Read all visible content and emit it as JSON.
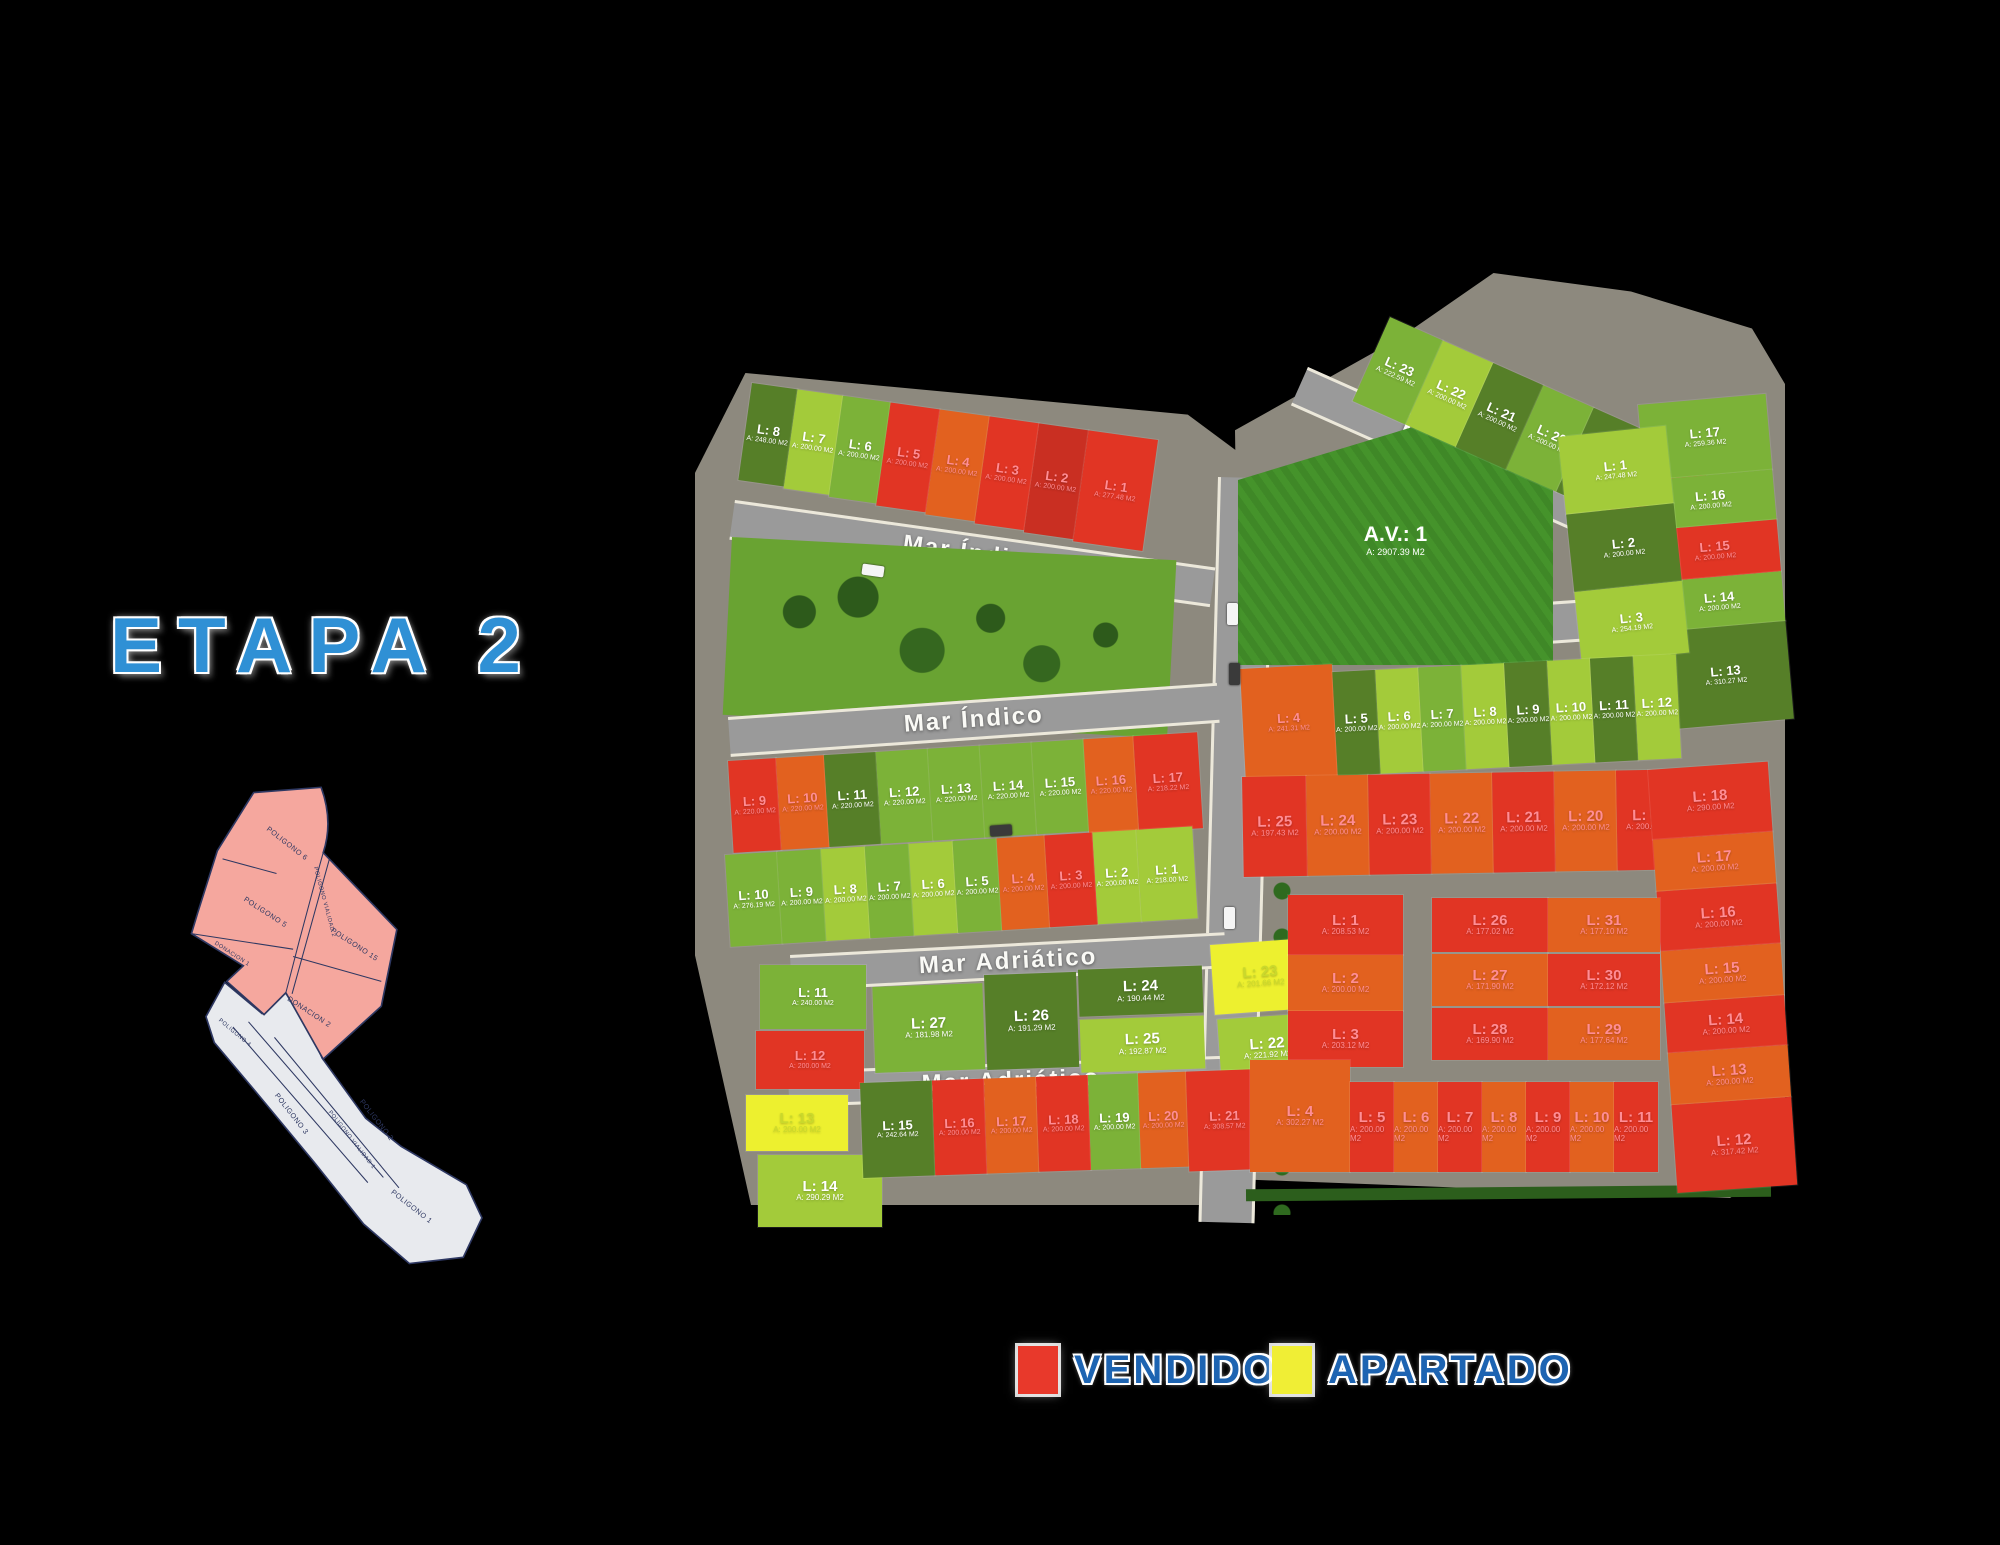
{
  "title": {
    "text": "ETAPA 2"
  },
  "legend": {
    "vendido": "VENDIDO",
    "apartado": "APARTADO"
  },
  "colors": {
    "g1": "#a3cb3a",
    "g2": "#7cb238",
    "g3": "#567f28",
    "r1": "#e13524",
    "r2": "#e2611f",
    "r3": "#c92f22",
    "y": "#edf02f",
    "av_field": "#45932b",
    "road": "#8f8f8f",
    "park": "#69a332",
    "legend_vendido": "#e8392b",
    "legend_apartado": "#f0ee35",
    "title_blue": "#2f90d5",
    "legend_blue": "#1d64b2"
  },
  "streets": [
    {
      "name": "Mar Índico"
    },
    {
      "name": "Mar Índico"
    },
    {
      "name": "Mar Rojo"
    },
    {
      "name": "Mar Rojo"
    },
    {
      "name": "Mar Adriático"
    },
    {
      "name": "Mar Adriático"
    }
  ],
  "inset": {
    "p6": "POLIGONO 6",
    "p5": "POLIGONO 5",
    "d1": "DONACION 1",
    "pv2": "POLIGONO VIALIDAD 2",
    "p15": "POLIGONO 15",
    "d2": "DONACION 2",
    "p4": "POLIGONO 4",
    "p3": "POLIGONO 3",
    "pv1": "POLIGONO VIALIDAD 1",
    "p2": "POLIGONO 2",
    "p1": "POLIGONO 1"
  },
  "zones": {
    "av": {
      "l": "A.V.: 1",
      "a": "A: 2907.39 M2"
    },
    "west_top_row": {
      "mode": "row",
      "lots": [
        {
          "l": "L: 8",
          "a": "A: 248.00 M2",
          "c": "g3",
          "w": 46,
          "h": 98
        },
        {
          "l": "L: 7",
          "a": "A: 200.00 M2",
          "c": "g1",
          "w": 46,
          "h": 100
        },
        {
          "l": "L: 6",
          "a": "A: 200.00 M2",
          "c": "g2",
          "w": 48,
          "h": 102
        },
        {
          "l": "L: 5",
          "a": "A: 200.00 M2",
          "c": "r1",
          "w": 50,
          "h": 104
        },
        {
          "l": "L: 4",
          "a": "A: 200.00 M2",
          "c": "r2",
          "w": 50,
          "h": 106
        },
        {
          "l": "L: 3",
          "a": "A: 200.00 M2",
          "c": "r1",
          "w": 50,
          "h": 108
        },
        {
          "l": "L: 2",
          "a": "A: 200.00 M2",
          "c": "r3",
          "w": 50,
          "h": 110
        },
        {
          "l": "L: 1",
          "a": "A: 277.48 M2",
          "c": "r1",
          "w": 70,
          "h": 112
        }
      ]
    },
    "west_mid_row1": {
      "mode": "row",
      "lots": [
        {
          "l": "L: 9",
          "a": "A: 220.00 M2",
          "c": "r1",
          "w": 48,
          "h": 92
        },
        {
          "l": "L: 10",
          "a": "A: 220.00 M2",
          "c": "r2",
          "w": 48,
          "h": 92
        },
        {
          "l": "L: 11",
          "a": "A: 220.00 M2",
          "c": "g3",
          "w": 52,
          "h": 92
        },
        {
          "l": "L: 12",
          "a": "A: 220.00 M2",
          "c": "g2",
          "w": 52,
          "h": 92
        },
        {
          "l": "L: 13",
          "a": "A: 220.00 M2",
          "c": "g2",
          "w": 52,
          "h": 92
        },
        {
          "l": "L: 14",
          "a": "A: 220.00 M2",
          "c": "g2",
          "w": 52,
          "h": 92
        },
        {
          "l": "L: 15",
          "a": "A: 220.00 M2",
          "c": "g2",
          "w": 52,
          "h": 92
        },
        {
          "l": "L: 16",
          "a": "A: 220.00 M2",
          "c": "r2",
          "w": 50,
          "h": 94
        },
        {
          "l": "L: 17",
          "a": "A: 218.22 M2",
          "c": "r1",
          "w": 64,
          "h": 96
        }
      ]
    },
    "west_mid_row2": {
      "mode": "row",
      "lots": [
        {
          "l": "L: 10",
          "a": "A: 276.19 M2",
          "c": "g2",
          "w": 52,
          "h": 92
        },
        {
          "l": "L: 9",
          "a": "A: 200.00 M2",
          "c": "g2",
          "w": 44,
          "h": 92
        },
        {
          "l": "L: 8",
          "a": "A: 200.00 M2",
          "c": "g1",
          "w": 44,
          "h": 92
        },
        {
          "l": "L: 7",
          "a": "A: 200.00 M2",
          "c": "g2",
          "w": 44,
          "h": 92
        },
        {
          "l": "L: 6",
          "a": "A: 200.00 M2",
          "c": "g1",
          "w": 44,
          "h": 92
        },
        {
          "l": "L: 5",
          "a": "A: 200.00 M2",
          "c": "g2",
          "w": 44,
          "h": 92
        },
        {
          "l": "L: 4",
          "a": "A: 200.00 M2",
          "c": "r2",
          "w": 48,
          "h": 92
        },
        {
          "l": "L: 3",
          "a": "A: 200.00 M2",
          "c": "r1",
          "w": 48,
          "h": 92
        },
        {
          "l": "L: 2",
          "a": "A: 200.00 M2",
          "c": "g1",
          "w": 44,
          "h": 92
        },
        {
          "l": "L: 1",
          "a": "A: 218.00 M2",
          "c": "g1",
          "w": 56,
          "h": 92
        }
      ]
    },
    "adriatico_left": {
      "mode": "free",
      "lots": [
        {
          "l": "L: 11",
          "a": "A: 240.00 M2",
          "c": "g2",
          "x": 4,
          "y": 2,
          "w": 106,
          "h": 64
        },
        {
          "l": "L: 12",
          "a": "A: 200.00 M2",
          "c": "r1",
          "x": 0,
          "y": 68,
          "w": 108,
          "h": 58
        }
      ]
    },
    "adriatico_island": {
      "mode": "free",
      "lots": [
        {
          "l": "L: 27",
          "a": "A: 181.98 M2",
          "c": "g2",
          "x": 0,
          "y": 10,
          "w": 110,
          "h": 86
        },
        {
          "l": "L: 26",
          "a": "A: 191.29 M2",
          "c": "g3",
          "x": 112,
          "y": 2,
          "w": 92,
          "h": 95
        },
        {
          "l": "L: 24",
          "a": "A: 190.44 M2",
          "c": "g3",
          "x": 206,
          "y": 0,
          "w": 124,
          "h": 47
        },
        {
          "l": "L: 25",
          "a": "A: 192.87 M2",
          "c": "g1",
          "x": 206,
          "y": 50,
          "w": 124,
          "h": 53
        }
      ]
    },
    "adriatico_right": {
      "mode": "free",
      "lots": [
        {
          "l": "L: 23",
          "a": "A: 201.66 M2",
          "c": "y",
          "x": 0,
          "y": 0,
          "w": 96,
          "h": 70
        },
        {
          "l": "L: 22",
          "a": "A: 221.92 M2",
          "c": "g1",
          "x": 2,
          "y": 75,
          "w": 96,
          "h": 64
        }
      ]
    },
    "west_bottom_left": {
      "mode": "free",
      "lots": [
        {
          "l": "L: 13",
          "a": "A: 200.00 M2",
          "c": "y",
          "x": 2,
          "y": 0,
          "w": 102,
          "h": 56
        },
        {
          "l": "L: 14",
          "a": "A: 290.29 M2",
          "c": "g1",
          "x": 14,
          "y": 60,
          "w": 124,
          "h": 72
        }
      ]
    },
    "west_bottom_row": {
      "mode": "row",
      "lots": [
        {
          "l": "L: 15",
          "a": "A: 242.64 M2",
          "c": "g3",
          "w": 72,
          "h": 95
        },
        {
          "l": "L: 16",
          "a": "A: 200.00 M2",
          "c": "r1",
          "w": 52,
          "h": 95
        },
        {
          "l": "L: 17",
          "a": "A: 200.00 M2",
          "c": "r2",
          "w": 52,
          "h": 95
        },
        {
          "l": "L: 18",
          "a": "A: 200.00 M2",
          "c": "r1",
          "w": 52,
          "h": 95
        },
        {
          "l": "L: 19",
          "a": "A: 200.00 M2",
          "c": "g2",
          "w": 50,
          "h": 95
        },
        {
          "l": "L: 20",
          "a": "A: 200.00 M2",
          "c": "r2",
          "w": 48,
          "h": 95
        },
        {
          "l": "L: 21",
          "a": "A: 308.57 M2",
          "c": "r1",
          "w": 74,
          "h": 100
        }
      ]
    },
    "east_top_row": {
      "mode": "row",
      "lots": [
        {
          "l": "L: 23",
          "a": "A: 222.59 M2",
          "c": "g2",
          "w": 58,
          "h": 92
        },
        {
          "l": "L: 22",
          "a": "A: 200.00 M2",
          "c": "g1",
          "w": 55,
          "h": 92
        },
        {
          "l": "L: 21",
          "a": "A: 200.00 M2",
          "c": "g3",
          "w": 55,
          "h": 92
        },
        {
          "l": "L: 20",
          "a": "A: 200.00 M2",
          "c": "g2",
          "w": 55,
          "h": 92
        },
        {
          "l": "L: 19",
          "a": "A: 200.00 M2",
          "c": "g3",
          "w": 55,
          "h": 92
        },
        {
          "l": "L: 18",
          "a": "A: 254.00 M2",
          "c": "r1",
          "w": 75,
          "h": 92
        }
      ]
    },
    "east_right_col": {
      "mode": "col",
      "lots": [
        {
          "l": "L: 17",
          "a": "A: 259.36 M2",
          "c": "g2",
          "w": 128,
          "h": 76
        },
        {
          "l": "L: 16",
          "a": "A: 200.00 M2",
          "c": "g2",
          "w": 128,
          "h": 50
        },
        {
          "l": "L: 15",
          "a": "A: 200.00 M2",
          "c": "r1",
          "w": 128,
          "h": 52
        },
        {
          "l": "L: 14",
          "a": "A: 200.00 M2",
          "c": "g2",
          "w": 128,
          "h": 50
        },
        {
          "l": "L: 13",
          "a": "A: 310.27 M2",
          "c": "g3",
          "w": 128,
          "h": 98
        }
      ]
    },
    "east_inner_col": {
      "mode": "col",
      "lots": [
        {
          "l": "L: 1",
          "a": "A: 247.48 M2",
          "c": "g1",
          "w": 108,
          "h": 78
        },
        {
          "l": "L: 2",
          "a": "A: 200.00 M2",
          "c": "g3",
          "w": 108,
          "h": 78
        },
        {
          "l": "L: 3",
          "a": "A: 254.19 M2",
          "c": "g1",
          "w": 108,
          "h": 72
        }
      ]
    },
    "east_mid_row": {
      "mode": "row",
      "lots": [
        {
          "l": "L: 4",
          "a": "A: 241.31 M2",
          "c": "r2",
          "w": 92,
          "h": 112
        },
        {
          "l": "L: 5",
          "a": "A: 200.00 M2",
          "c": "g3",
          "w": 43,
          "h": 104
        },
        {
          "l": "L: 6",
          "a": "A: 200.00 M2",
          "c": "g1",
          "w": 43,
          "h": 104
        },
        {
          "l": "L: 7",
          "a": "A: 200.00 M2",
          "c": "g2",
          "w": 43,
          "h": 104
        },
        {
          "l": "L: 8",
          "a": "A: 200.00 M2",
          "c": "g1",
          "w": 43,
          "h": 104
        },
        {
          "l": "L: 9",
          "a": "A: 200.00 M2",
          "c": "g3",
          "w": 43,
          "h": 104
        },
        {
          "l": "L: 10",
          "a": "A: 200.00 M2",
          "c": "g1",
          "w": 43,
          "h": 104
        },
        {
          "l": "L: 11",
          "a": "A: 200.00 M2",
          "c": "g3",
          "w": 43,
          "h": 104
        },
        {
          "l": "L: 12",
          "a": "A: 200.00 M2",
          "c": "g1",
          "w": 43,
          "h": 104
        }
      ]
    },
    "se_top_row": {
      "mode": "row",
      "lots": [
        {
          "l": "L: 25",
          "a": "A: 197.43 M2",
          "c": "r1",
          "w": 64,
          "h": 100
        },
        {
          "l": "L: 24",
          "a": "A: 200.00 M2",
          "c": "r2",
          "w": 62,
          "h": 100
        },
        {
          "l": "L: 23",
          "a": "A: 200.00 M2",
          "c": "r1",
          "w": 62,
          "h": 100
        },
        {
          "l": "L: 22",
          "a": "A: 200.00 M2",
          "c": "r2",
          "w": 62,
          "h": 100
        },
        {
          "l": "L: 21",
          "a": "A: 200.00 M2",
          "c": "r1",
          "w": 62,
          "h": 100
        },
        {
          "l": "L: 20",
          "a": "A: 200.00 M2",
          "c": "r2",
          "w": 62,
          "h": 100
        },
        {
          "l": "L: 19",
          "a": "A: 200.00 M2",
          "c": "r1",
          "w": 66,
          "h": 100
        }
      ]
    },
    "se_right_col": {
      "mode": "col",
      "lots": [
        {
          "l": "L: 18",
          "a": "A: 290.00 M2",
          "c": "r1",
          "w": 120,
          "h": 70
        },
        {
          "l": "L: 17",
          "a": "A: 200.00 M2",
          "c": "r2",
          "w": 120,
          "h": 52
        },
        {
          "l": "L: 16",
          "a": "A: 200.00 M2",
          "c": "r1",
          "w": 120,
          "h": 60
        },
        {
          "l": "L: 15",
          "a": "A: 200.00 M2",
          "c": "r2",
          "w": 120,
          "h": 52
        },
        {
          "l": "L: 14",
          "a": "A: 200.00 M2",
          "c": "r1",
          "w": 120,
          "h": 50
        },
        {
          "l": "L: 13",
          "a": "A: 200.00 M2",
          "c": "r2",
          "w": 120,
          "h": 52
        },
        {
          "l": "L: 12",
          "a": "A: 317.42 M2",
          "c": "r1",
          "w": 120,
          "h": 88
        }
      ]
    },
    "se_left_col": {
      "mode": "col",
      "lots": [
        {
          "l": "L: 1",
          "a": "A: 208.53 M2",
          "c": "r1",
          "w": 115,
          "h": 60
        },
        {
          "l": "L: 2",
          "a": "A: 200.00 M2",
          "c": "r2",
          "w": 115,
          "h": 56
        },
        {
          "l": "L: 3",
          "a": "A: 203.12 M2",
          "c": "r1",
          "w": 115,
          "h": 56
        }
      ]
    },
    "se_island": {
      "mode": "free",
      "lots": [
        {
          "l": "L: 26",
          "a": "A: 177.02 M2",
          "c": "r1",
          "x": 0,
          "y": 0,
          "w": 116,
          "h": 54
        },
        {
          "l": "L: 31",
          "a": "A: 177.10 M2",
          "c": "r2",
          "x": 116,
          "y": 0,
          "w": 112,
          "h": 54
        },
        {
          "l": "L: 27",
          "a": "A: 171.90 M2",
          "c": "r2",
          "x": 0,
          "y": 56,
          "w": 116,
          "h": 52
        },
        {
          "l": "L: 30",
          "a": "A: 172.12 M2",
          "c": "r1",
          "x": 116,
          "y": 56,
          "w": 112,
          "h": 52
        },
        {
          "l": "L: 28",
          "a": "A: 169.90 M2",
          "c": "r1",
          "x": 0,
          "y": 110,
          "w": 116,
          "h": 52
        },
        {
          "l": "L: 29",
          "a": "A: 177.64 M2",
          "c": "r2",
          "x": 116,
          "y": 110,
          "w": 112,
          "h": 52
        }
      ]
    },
    "se_bottom_row": {
      "mode": "row",
      "lots": [
        {
          "l": "L: 4",
          "a": "A: 302.27 M2",
          "c": "r2",
          "w": 100,
          "h": 112
        },
        {
          "l": "L: 5",
          "a": "A: 200.00 M2",
          "c": "r1",
          "w": 44,
          "h": 90
        },
        {
          "l": "L: 6",
          "a": "A: 200.00 M2",
          "c": "r2",
          "w": 44,
          "h": 90
        },
        {
          "l": "L: 7",
          "a": "A: 200.00 M2",
          "c": "r1",
          "w": 44,
          "h": 90
        },
        {
          "l": "L: 8",
          "a": "A: 200.00 M2",
          "c": "r2",
          "w": 44,
          "h": 90
        },
        {
          "l": "L: 9",
          "a": "A: 200.00 M2",
          "c": "r1",
          "w": 44,
          "h": 90
        },
        {
          "l": "L: 10",
          "a": "A: 200.00 M2",
          "c": "r2",
          "w": 44,
          "h": 90
        },
        {
          "l": "L: 11",
          "a": "A: 200.00 M2",
          "c": "r1",
          "w": 44,
          "h": 90
        }
      ]
    }
  }
}
